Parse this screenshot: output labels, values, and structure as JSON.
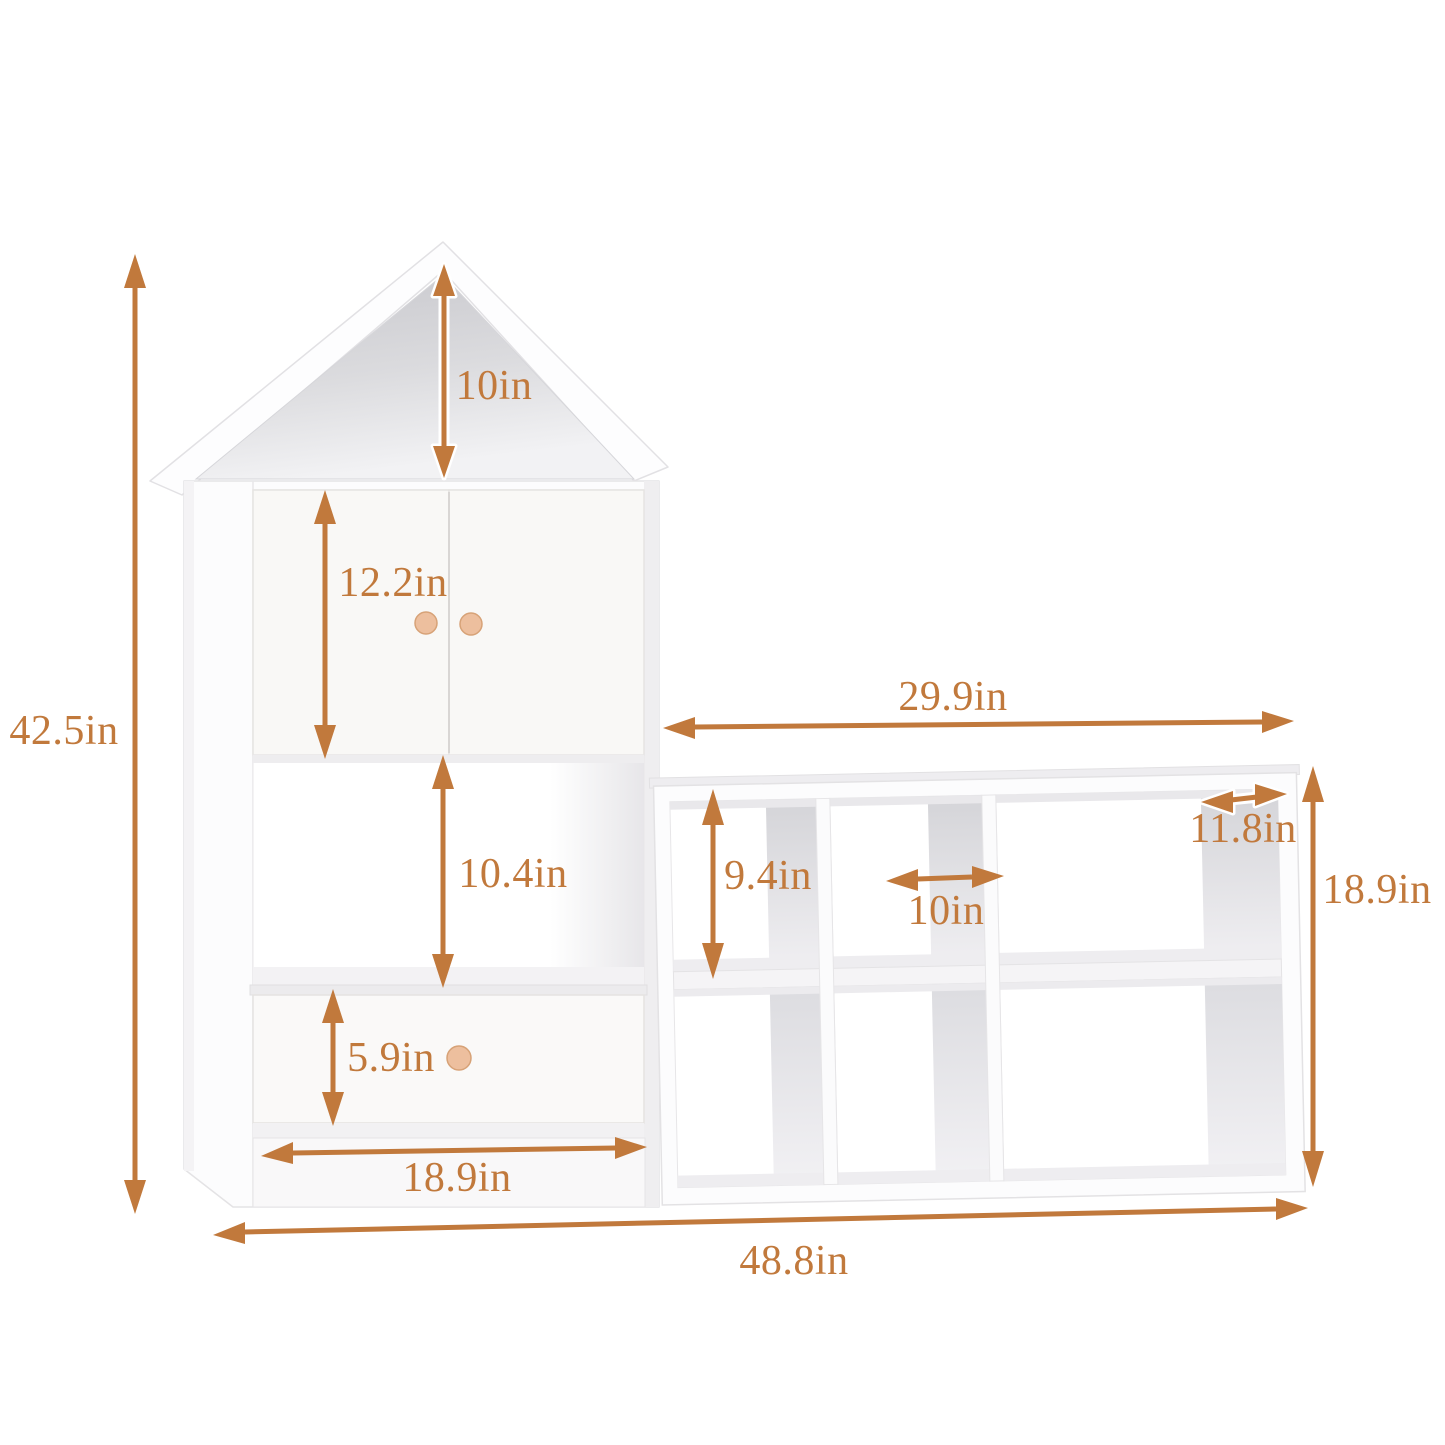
{
  "page": {
    "background": "#ffffff",
    "accent_color": "#C1793C",
    "knob_color": "#EDBF9E",
    "furniture_color": "#FCFCFD",
    "unit": "in"
  },
  "dimensions": {
    "total_height": "42.5in",
    "roof_height": "10in",
    "door_height": "12.2in",
    "open_shelf_height": "10.4in",
    "drawer_height": "5.9in",
    "house_width": "18.9in",
    "total_width": "48.8in",
    "cube_shelf_width": "29.9in",
    "cube_cell_height": "9.4in",
    "cube_cell_width": "10in",
    "cube_depth": "11.8in",
    "cube_shelf_height": "18.9in"
  }
}
